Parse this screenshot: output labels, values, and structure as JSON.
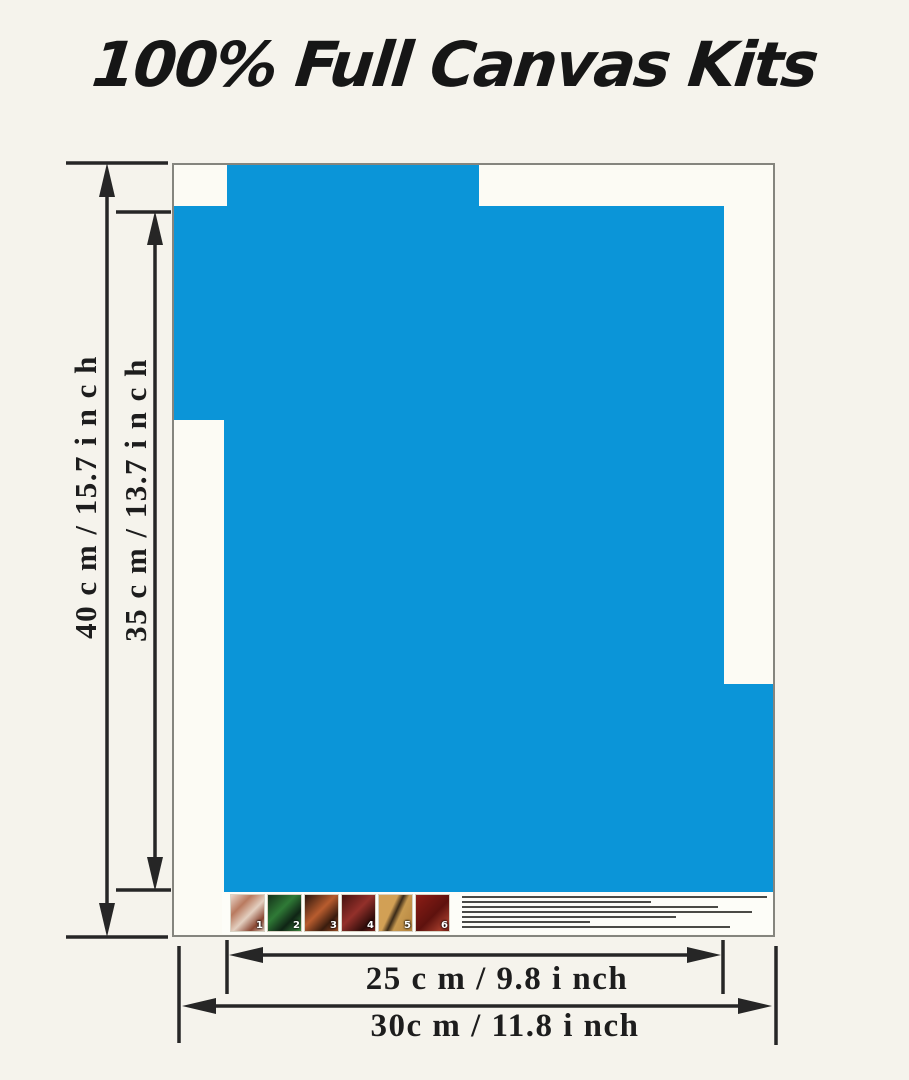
{
  "title": "100% Full Canvas Kits",
  "dimensions": {
    "outer_height": "40 c m /    15.7 i n c h",
    "inner_height": "35 c m /    13.7 i n c h",
    "inner_width": "25 c m /  9.8 i nch",
    "outer_width": "30c m /   11.8 i nch"
  },
  "legend": {
    "steps": [
      {
        "number": "1"
      },
      {
        "number": "2"
      },
      {
        "number": "3"
      },
      {
        "number": "4"
      },
      {
        "number": "5"
      },
      {
        "number": "6"
      }
    ]
  },
  "colors": {
    "background": "#f5f3ec",
    "canvas_background": "#fcfbf4",
    "canvas_border": "#85857e",
    "canvas_blue": "#0b95d8",
    "dimension_lines": "#262626",
    "title_text": "#161616"
  }
}
